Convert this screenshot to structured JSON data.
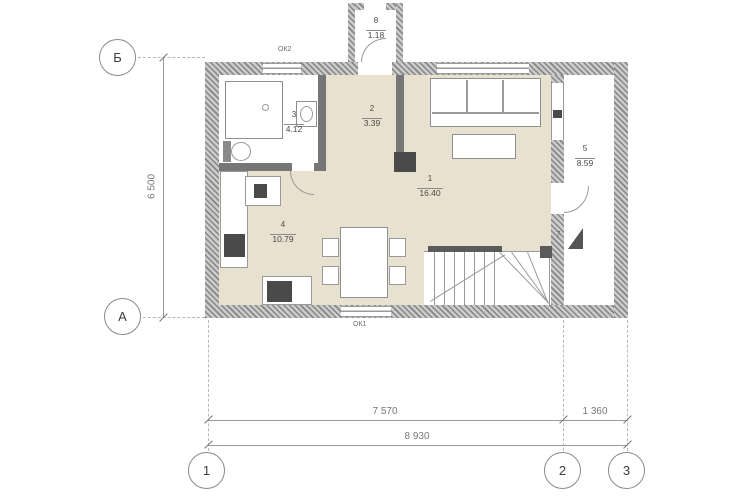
{
  "plan": {
    "axes": {
      "b": "Б",
      "a": "А",
      "c1": "1",
      "c2": "2",
      "c3": "3"
    },
    "dims": {
      "left": "6 500",
      "s12": "7 570",
      "s23": "1 360",
      "total": "8 930"
    },
    "rooms": [
      {
        "number": "1",
        "area": "16.40"
      },
      {
        "number": "2",
        "area": "3.39"
      },
      {
        "number": "3",
        "area": "4.12"
      },
      {
        "number": "4",
        "area": "10.79"
      },
      {
        "number": "5",
        "area": "8.59"
      },
      {
        "number": "8",
        "area": "1.18"
      }
    ],
    "marks": {
      "steps": "7",
      "window_tag_top": "ОК2",
      "window_tag_bottom": "ОК1"
    },
    "colors": {
      "floor": "#e9e1cf",
      "wall": "#868686",
      "appliance": "#4a4a4a",
      "line": "#9a9a9a"
    }
  }
}
